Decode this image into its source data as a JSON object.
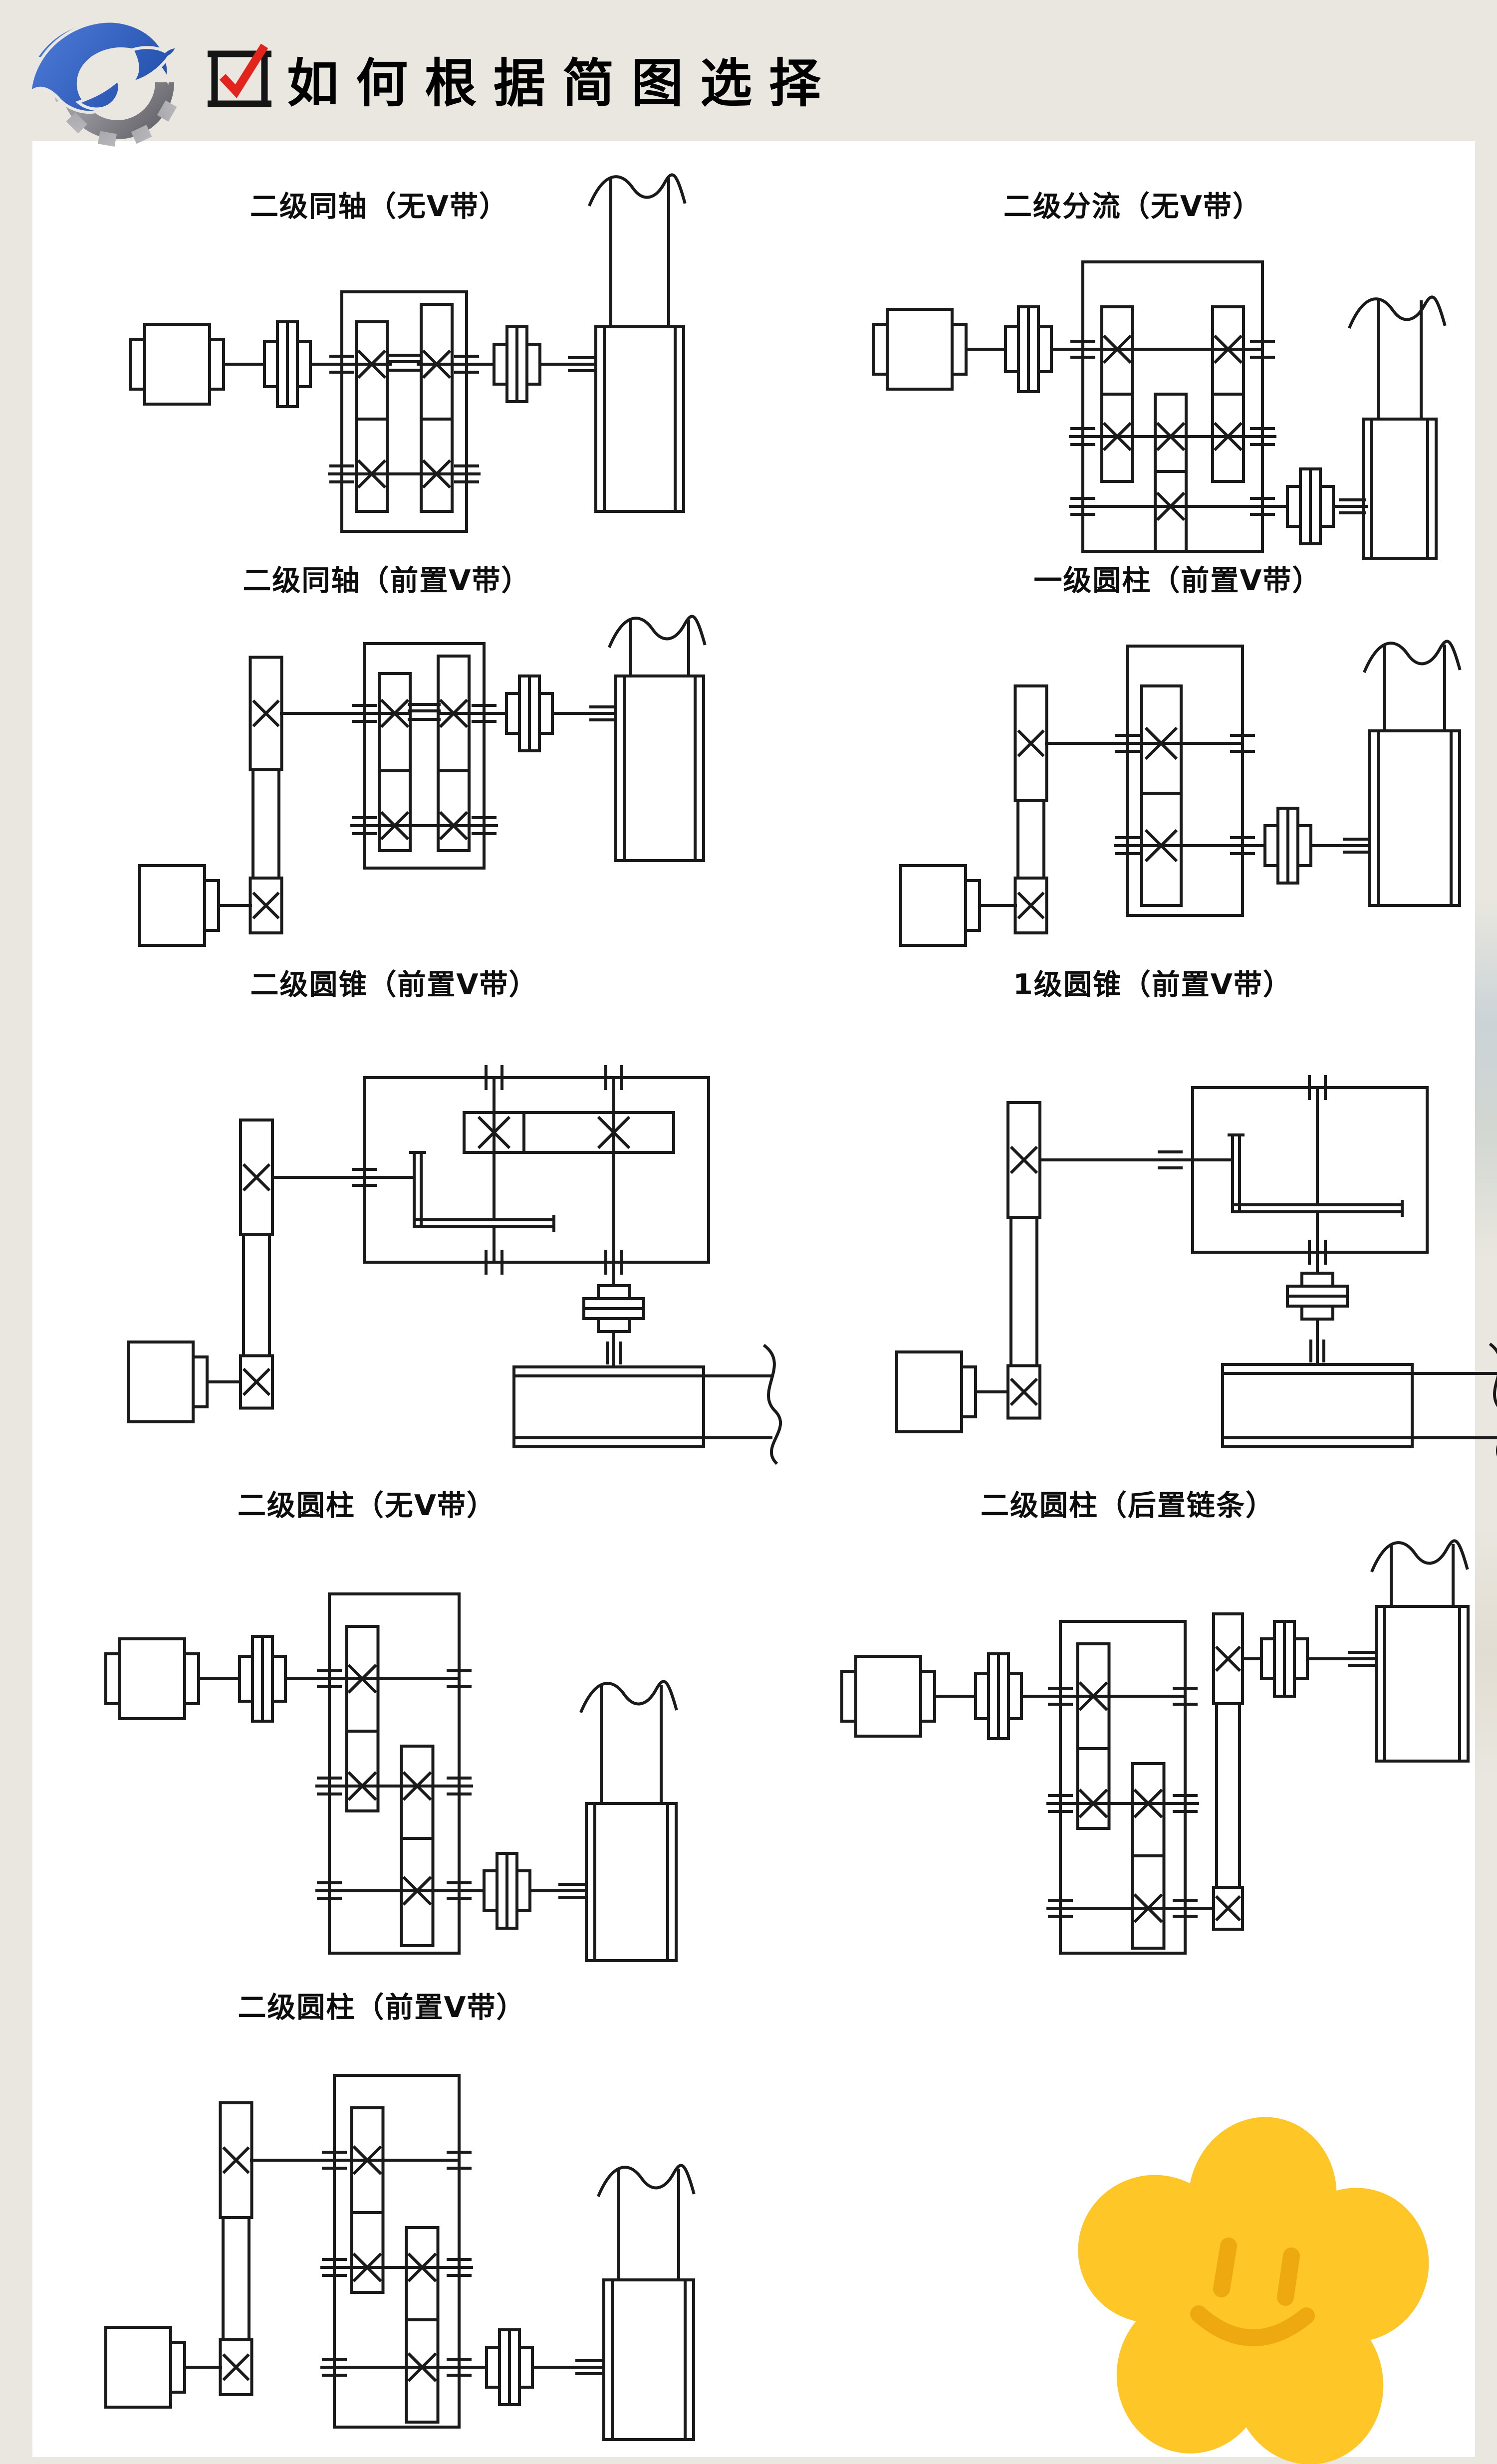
{
  "header": {
    "title": "如何根据简图选择",
    "logo_icon": "gear-swoosh-logo",
    "check_icon": "checkbox-checkmark-icon"
  },
  "colors": {
    "page_bg": "#e9e7df",
    "panel_bg": "#ffffff",
    "line": "#1a1a1a",
    "title_color": "#000000",
    "check_red": "#e3241c",
    "logo_blue_light": "#4a79d4",
    "logo_blue_dark": "#1f4aa8",
    "logo_gray_light": "#c6c6ca",
    "logo_gray_dark": "#595960",
    "flower_petal": "#ffc628",
    "flower_face": "#eda90f"
  },
  "diagrams": [
    {
      "label": "二级同轴（无V带）",
      "type": "coaxial-2stage"
    },
    {
      "label": "二级分流（无V带）",
      "type": "split-2stage"
    },
    {
      "label": "二级同轴（前置V带）",
      "type": "coaxial-2stage-belt"
    },
    {
      "label": "一级圆柱（前置V带）",
      "type": "cylindrical-1stage-belt"
    },
    {
      "label": "二级圆锥（前置V带）",
      "type": "bevel-2stage-belt"
    },
    {
      "label": "1级圆锥（前置V带）",
      "type": "bevel-1stage-belt"
    },
    {
      "label": "二级圆柱（无V带）",
      "type": "cylindrical-2stage"
    },
    {
      "label": "二级圆柱（后置链条）",
      "type": "cylindrical-2stage-chain"
    },
    {
      "label": "二级圆柱（前置V带）",
      "type": "cylindrical-2stage-belt"
    }
  ],
  "decoration": {
    "flower_icon": "smiley-flower-icon"
  }
}
